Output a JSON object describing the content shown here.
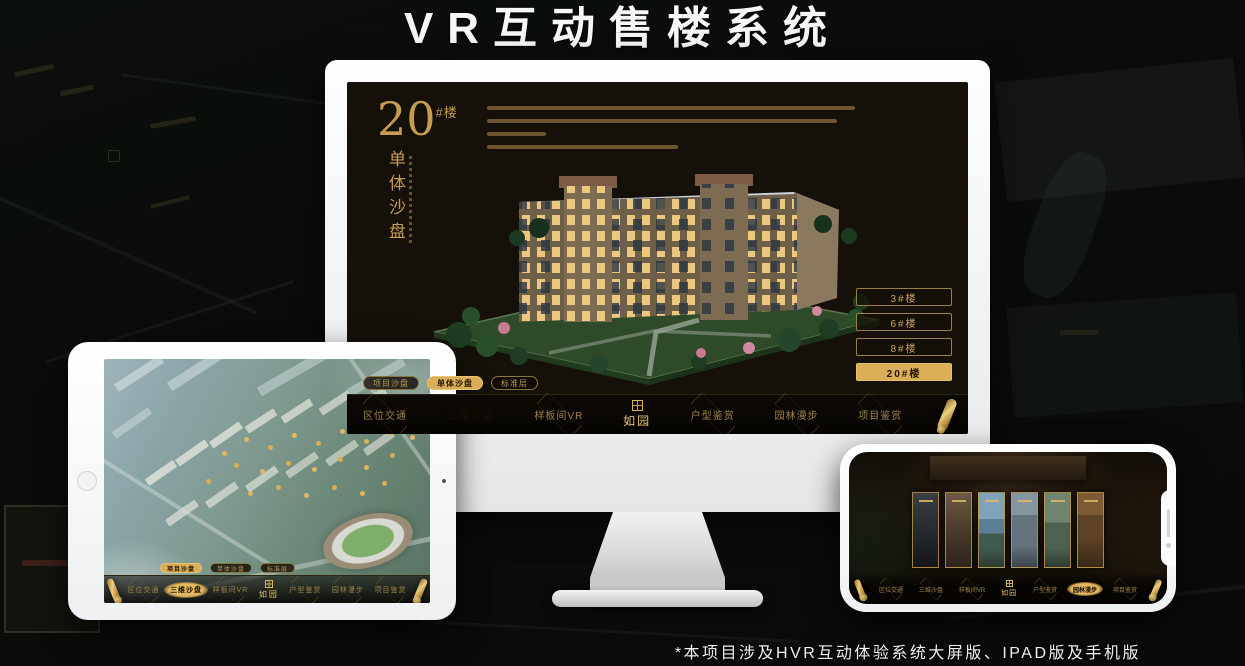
{
  "title": "VR互动售楼系统",
  "footnote": "*本项目涉及HVR互动体验系统大屏版、IPAD版及手机版",
  "brand": {
    "logo_text": "如园"
  },
  "colors": {
    "gold": "#d9ae57",
    "gold_bright": "#e8c272",
    "screen_bg": "#15100a",
    "title_white": "#f7f7f7"
  },
  "nav_items": [
    "区位交通",
    "三维沙盘",
    "样板间VR",
    "户型鉴赏",
    "园林漫步",
    "项目鉴赏"
  ],
  "sub_tabs": [
    "项目沙盘",
    "单体沙盘",
    "标准层"
  ],
  "monitor": {
    "heading_number": "20",
    "heading_suffix": "#楼",
    "heading_sub": "单体沙盘",
    "floor_buttons": [
      "3#楼",
      "6#楼",
      "8#楼",
      "20#楼"
    ],
    "active_floor": "20#楼",
    "active_sub_tab": "单体沙盘",
    "active_nav_item": "三维沙盘"
  },
  "ipad": {
    "active_sub_tab": "项目沙盘",
    "active_nav_item": "三维沙盘"
  },
  "phone": {
    "active_nav_item": "园林漫步",
    "gallery_panel_count": 6
  }
}
